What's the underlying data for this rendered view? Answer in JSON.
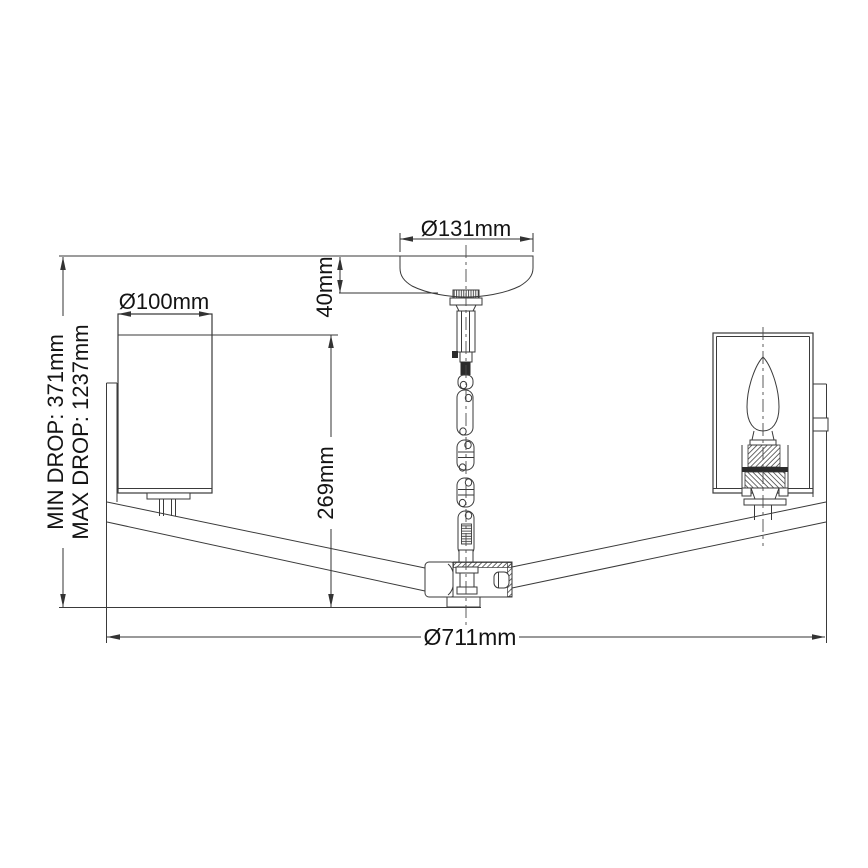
{
  "drawing": {
    "type": "technical-dimension-drawing",
    "subject": "3-arm semi-flush chandelier with cylinder glass shades, elevation view",
    "dimensions": {
      "canopy_diameter": "Ø131mm",
      "canopy_height": "40mm",
      "shade_diameter": "Ø100mm",
      "shade_drop": "269mm",
      "fixture_diameter": "Ø711mm",
      "min_drop": "MIN DROP: 371mm",
      "max_drop": "MAX DROP: 1237mm"
    },
    "colors": {
      "line": "#3a3a3a",
      "dimension_line": "#333333",
      "text": "#141414",
      "background": "#ffffff"
    }
  }
}
